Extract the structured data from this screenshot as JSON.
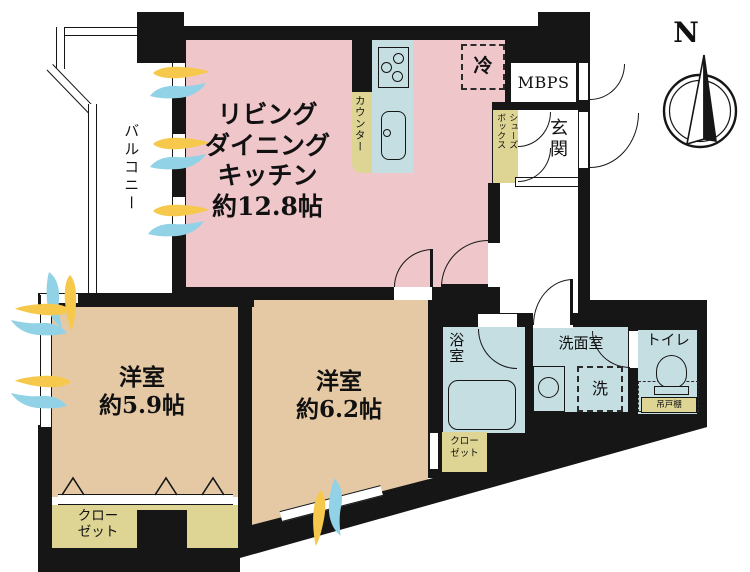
{
  "plan_title": "apartment-floor-plan",
  "colors": {
    "wall": "#161616",
    "ldk_pink": "#efc6ca",
    "bedroom_tan": "#e5c9a5",
    "storage_khaki": "#ded594",
    "wet_blue": "#c5dee2",
    "breeze_yellow": "#f6c94c",
    "breeze_cyan": "#92d2e6"
  },
  "compass": {
    "north_label": "N"
  },
  "rooms": {
    "ldk": {
      "label": "リビング\nダイニング\nキッチン\n約12.8帖"
    },
    "balcony": {
      "label": "バルコニー"
    },
    "counter": {
      "label": "カウンター"
    },
    "fridge": {
      "label": "冷"
    },
    "mbps": {
      "label": "MBPS"
    },
    "entrance": {
      "label": "玄関"
    },
    "shoebox": {
      "label": "シューズ\nボックス"
    },
    "bedroom1": {
      "label": "洋室\n約5.9帖"
    },
    "bedroom2": {
      "label": "洋室\n約6.2帖"
    },
    "closet1": {
      "label": "クロー\nゼット"
    },
    "closet2": {
      "label": "クロー\nゼット"
    },
    "bath": {
      "label": "浴室"
    },
    "washroom": {
      "label": "洗面室"
    },
    "washer": {
      "label": "洗"
    },
    "toilet": {
      "label": "トイレ"
    },
    "cupboard": {
      "label": "吊戸棚"
    }
  }
}
